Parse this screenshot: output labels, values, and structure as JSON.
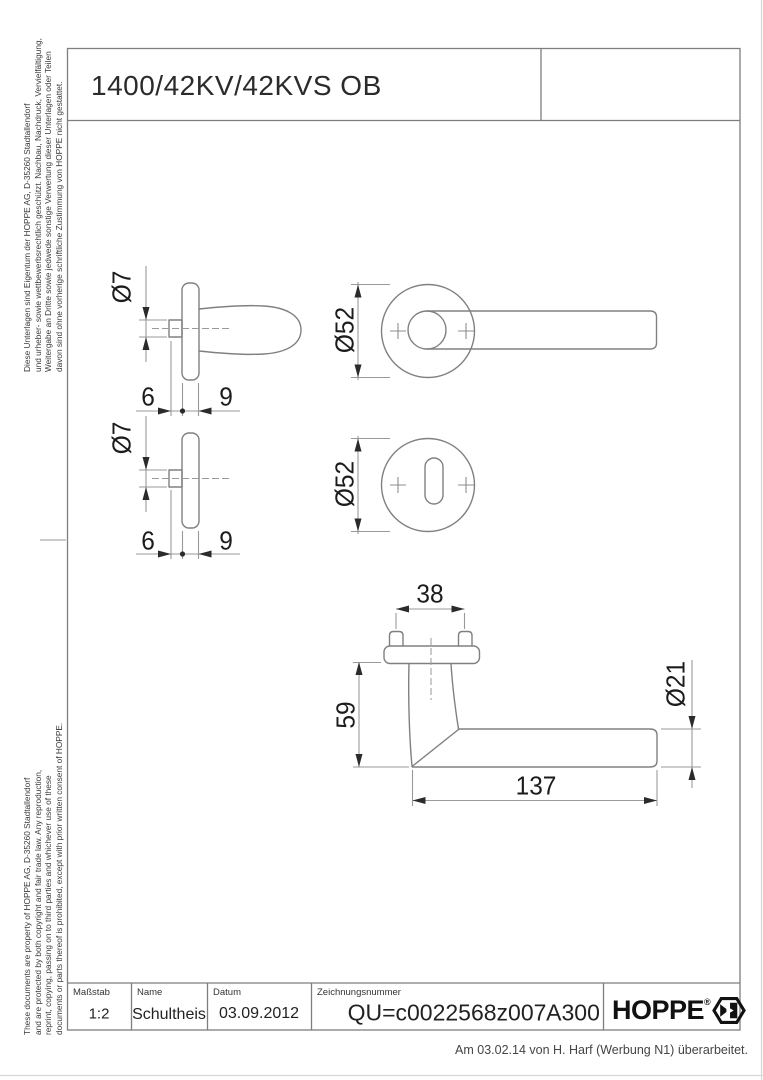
{
  "page": {
    "title": "1400/42KV/42KVS OB"
  },
  "views": {
    "handle_side": {
      "spindle_dia": "Ø7",
      "dim_6": "6",
      "dim_9": "9"
    },
    "handle_front": {
      "rose_dia": "Ø52"
    },
    "key_side": {
      "spindle_dia": "Ø7",
      "dim_6": "6",
      "dim_9": "9"
    },
    "key_front": {
      "rose_dia": "Ø52"
    },
    "mounted": {
      "screw_spacing": "38",
      "neck_height": "59",
      "lever_length": "137",
      "lever_dia": "Ø21"
    }
  },
  "legal": {
    "german_lines": [
      "Diese Unterlagen sind Eigentum der  HOPPE AG, D-35260 Stadtallendorf",
      "und urheber- sowie wettbewerbsrechtlich geschützt. Nachbau, Nachdruck, Vervielfältigung,",
      "Weitergabe an Dritte sowie jedwede sonstige Verwertung dieser Unterlagen oder Teilen",
      "davon sind ohne vorherige schriftliche Zustimmung von HOPPE nicht gestattet."
    ],
    "english_lines": [
      "These documents are property of HOPPE AG, D-35260 Stadtallendorf",
      "and are protected by both copyright and fair trade law. Any reproduction,",
      "reprint, copying, passing on to third parties and whichever use of these",
      "documents or parts thereof is prohibited, except with prior written consent of HOPPE."
    ]
  },
  "title_block": {
    "scale_label": "Maßstab",
    "scale_value": "1:2",
    "name_label": "Name",
    "name_value": "Schultheis",
    "date_label": "Datum",
    "date_value": "03.09.2012",
    "number_label": "Zeichnungsnummer",
    "number_value": "QU=c0022568z007",
    "revision": "A300",
    "brand": "HOPPE",
    "brand_reg": "®"
  },
  "footer": {
    "note": "Am 03.02.14 von H. Harf (Werbung N1) überarbeitet."
  },
  "colors": {
    "paper": "#ffffff",
    "outline_ink": "#808080",
    "dimension_ink": "#9a9a9a",
    "text_ink": "#1c1c1c",
    "frame_ink": "#7e7e7e"
  }
}
